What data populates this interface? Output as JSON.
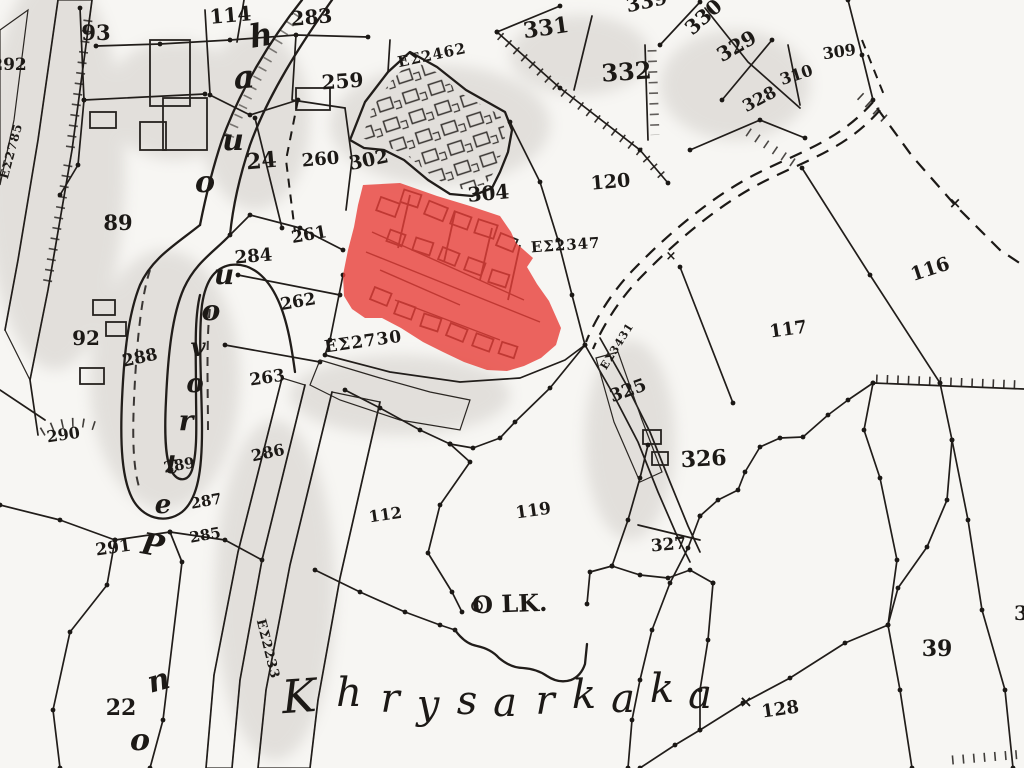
{
  "map": {
    "place_name": "Khrysarkaka",
    "landmark_text": "O LK.",
    "highlight_color": "#e73f38",
    "ink_color": "#211d1a",
    "paper_color": "#f6f5f2",
    "highlight_adjacent_refs": [
      "ΕΣ2347",
      "ΕΣ2730"
    ],
    "labels": [
      {
        "t": "93",
        "x": 96,
        "y": 40,
        "s": 21,
        "r": 0,
        "c": "num"
      },
      {
        "t": "114",
        "x": 231,
        "y": 22,
        "s": 20,
        "r": -5,
        "c": "num"
      },
      {
        "t": "283",
        "x": 312,
        "y": 24,
        "s": 20,
        "r": -5,
        "c": "num"
      },
      {
        "t": "292",
        "x": 9,
        "y": 70,
        "s": 17,
        "r": 0,
        "c": "num"
      },
      {
        "t": "259",
        "x": 343,
        "y": 88,
        "s": 20,
        "r": -4,
        "c": "num"
      },
      {
        "t": "ΕΣ2462",
        "x": 433,
        "y": 60,
        "s": 15,
        "r": -12,
        "c": "enum"
      },
      {
        "t": "331",
        "x": 547,
        "y": 35,
        "s": 22,
        "r": -8,
        "c": "num"
      },
      {
        "t": "332",
        "x": 627,
        "y": 80,
        "s": 24,
        "r": -4,
        "c": "num"
      },
      {
        "t": "339",
        "x": 648,
        "y": 8,
        "s": 20,
        "r": -12,
        "c": "num"
      },
      {
        "t": "330",
        "x": 708,
        "y": 22,
        "s": 20,
        "r": -42,
        "c": "num"
      },
      {
        "t": "329",
        "x": 740,
        "y": 52,
        "s": 20,
        "r": -30,
        "c": "num"
      },
      {
        "t": "310",
        "x": 798,
        "y": 80,
        "s": 16,
        "r": -18,
        "c": "num"
      },
      {
        "t": "309",
        "x": 840,
        "y": 57,
        "s": 16,
        "r": -8,
        "c": "num"
      },
      {
        "t": "328",
        "x": 762,
        "y": 104,
        "s": 17,
        "r": -28,
        "c": "num"
      },
      {
        "t": "24",
        "x": 262,
        "y": 168,
        "s": 22,
        "r": -5,
        "c": "num"
      },
      {
        "t": "260",
        "x": 321,
        "y": 165,
        "s": 18,
        "r": -5,
        "c": "num"
      },
      {
        "t": "302",
        "x": 370,
        "y": 166,
        "s": 19,
        "r": -12,
        "c": "num"
      },
      {
        "t": "304",
        "x": 489,
        "y": 200,
        "s": 20,
        "r": -5,
        "c": "num"
      },
      {
        "t": "261",
        "x": 310,
        "y": 240,
        "s": 17,
        "r": -10,
        "c": "num"
      },
      {
        "t": "284",
        "x": 254,
        "y": 262,
        "s": 18,
        "r": -5,
        "c": "num"
      },
      {
        "t": "89",
        "x": 118,
        "y": 230,
        "s": 21,
        "r": 0,
        "c": "num"
      },
      {
        "t": "262",
        "x": 299,
        "y": 307,
        "s": 17,
        "r": -10,
        "c": "num"
      },
      {
        "t": "92",
        "x": 86,
        "y": 345,
        "s": 20,
        "r": 0,
        "c": "num"
      },
      {
        "t": "288",
        "x": 141,
        "y": 363,
        "s": 17,
        "r": -12,
        "c": "num"
      },
      {
        "t": "263",
        "x": 268,
        "y": 383,
        "s": 17,
        "r": -8,
        "c": "num"
      },
      {
        "t": "290",
        "x": 64,
        "y": 440,
        "s": 16,
        "r": -8,
        "c": "num"
      },
      {
        "t": "286",
        "x": 269,
        "y": 458,
        "s": 16,
        "r": -12,
        "c": "num"
      },
      {
        "t": "289",
        "x": 180,
        "y": 470,
        "s": 15,
        "r": -10,
        "c": "num"
      },
      {
        "t": "287",
        "x": 207,
        "y": 506,
        "s": 15,
        "r": -10,
        "c": "num"
      },
      {
        "t": "285",
        "x": 206,
        "y": 540,
        "s": 15,
        "r": -10,
        "c": "num"
      },
      {
        "t": "291",
        "x": 114,
        "y": 553,
        "s": 17,
        "r": -8,
        "c": "num"
      },
      {
        "t": "22",
        "x": 121,
        "y": 715,
        "s": 22,
        "r": 0,
        "c": "num"
      },
      {
        "t": "112",
        "x": 386,
        "y": 520,
        "s": 16,
        "r": -8,
        "c": "num"
      },
      {
        "t": "119",
        "x": 534,
        "y": 516,
        "s": 17,
        "r": -8,
        "c": "num"
      },
      {
        "t": "120",
        "x": 611,
        "y": 188,
        "s": 19,
        "r": -5,
        "c": "num"
      },
      {
        "t": "ΕΣ2347",
        "x": 566,
        "y": 250,
        "s": 15,
        "r": -4,
        "c": "enum"
      },
      {
        "t": "ΕΣ2730",
        "x": 364,
        "y": 347,
        "s": 17,
        "r": -8,
        "c": "enum"
      },
      {
        "t": "116",
        "x": 932,
        "y": 275,
        "s": 19,
        "r": -18,
        "c": "num"
      },
      {
        "t": "117",
        "x": 789,
        "y": 335,
        "s": 18,
        "r": -8,
        "c": "num"
      },
      {
        "t": "325",
        "x": 630,
        "y": 396,
        "s": 18,
        "r": -20,
        "c": "num"
      },
      {
        "t": "ΕΣ3431",
        "x": 620,
        "y": 348,
        "s": 11,
        "r": -58,
        "c": "enum"
      },
      {
        "t": "326",
        "x": 704,
        "y": 466,
        "s": 22,
        "r": -3,
        "c": "num"
      },
      {
        "t": "327",
        "x": 669,
        "y": 550,
        "s": 17,
        "r": -5,
        "c": "num"
      },
      {
        "t": "O LK.",
        "x": 510,
        "y": 612,
        "s": 24,
        "r": -2,
        "c": "num"
      },
      {
        "t": "128",
        "x": 781,
        "y": 715,
        "s": 18,
        "r": -8,
        "c": "num"
      },
      {
        "t": "39",
        "x": 937,
        "y": 656,
        "s": 22,
        "r": 0,
        "c": "num"
      },
      {
        "t": "3",
        "x": 1021,
        "y": 620,
        "s": 20,
        "r": 0,
        "c": "num"
      },
      {
        "t": "ΕΣ2233",
        "x": 264,
        "y": 650,
        "s": 13,
        "r": 76,
        "c": "enum"
      },
      {
        "t": "ΕΣ2785",
        "x": 15,
        "y": 152,
        "s": 12,
        "r": -75,
        "c": "enum"
      },
      {
        "t": "×",
        "x": 746,
        "y": 707,
        "s": 16,
        "r": 0,
        "c": "mark"
      },
      {
        "t": "×",
        "x": 955,
        "y": 208,
        "s": 15,
        "r": 0,
        "c": "mark"
      },
      {
        "t": "×",
        "x": 671,
        "y": 260,
        "s": 13,
        "r": 0,
        "c": "mark"
      },
      {
        "t": "h",
        "x": 263,
        "y": 46,
        "s": 32,
        "r": -10,
        "c": "script"
      },
      {
        "t": "a",
        "x": 245,
        "y": 88,
        "s": 32,
        "r": -5,
        "c": "script"
      },
      {
        "t": "u",
        "x": 233,
        "y": 150,
        "s": 30,
        "r": 0,
        "c": "script"
      },
      {
        "t": "o",
        "x": 205,
        "y": 192,
        "s": 30,
        "r": 0,
        "c": "script"
      },
      {
        "t": "u",
        "x": 224,
        "y": 284,
        "s": 28,
        "r": 0,
        "c": "script"
      },
      {
        "t": "o",
        "x": 211,
        "y": 320,
        "s": 28,
        "r": 0,
        "c": "script"
      },
      {
        "t": "v",
        "x": 198,
        "y": 356,
        "s": 26,
        "r": 0,
        "c": "script"
      },
      {
        "t": "o",
        "x": 195,
        "y": 392,
        "s": 26,
        "r": 0,
        "c": "script"
      },
      {
        "t": "r",
        "x": 186,
        "y": 430,
        "s": 28,
        "r": 0,
        "c": "script"
      },
      {
        "t": "t",
        "x": 172,
        "y": 473,
        "s": 26,
        "r": 0,
        "c": "script"
      },
      {
        "t": "e",
        "x": 163,
        "y": 513,
        "s": 26,
        "r": 0,
        "c": "script"
      },
      {
        "t": "P",
        "x": 151,
        "y": 555,
        "s": 30,
        "r": 10,
        "c": "script"
      },
      {
        "t": "n",
        "x": 161,
        "y": 690,
        "s": 30,
        "r": -15,
        "c": "script"
      },
      {
        "t": "o",
        "x": 140,
        "y": 750,
        "s": 30,
        "r": 0,
        "c": "script"
      },
      {
        "t": "K",
        "x": 300,
        "y": 712,
        "s": 46,
        "r": -4,
        "c": "place"
      },
      {
        "t": "h",
        "x": 349,
        "y": 706,
        "s": 40,
        "r": 0,
        "c": "place"
      },
      {
        "t": "r",
        "x": 390,
        "y": 712,
        "s": 40,
        "r": 0,
        "c": "place"
      },
      {
        "t": "y",
        "x": 428,
        "y": 718,
        "s": 40,
        "r": 0,
        "c": "place"
      },
      {
        "t": "s",
        "x": 467,
        "y": 714,
        "s": 40,
        "r": 0,
        "c": "place"
      },
      {
        "t": "a",
        "x": 505,
        "y": 716,
        "s": 40,
        "r": 0,
        "c": "place"
      },
      {
        "t": "r",
        "x": 545,
        "y": 714,
        "s": 40,
        "r": 0,
        "c": "place"
      },
      {
        "t": "k",
        "x": 584,
        "y": 708,
        "s": 40,
        "r": 0,
        "c": "place"
      },
      {
        "t": "a",
        "x": 623,
        "y": 712,
        "s": 40,
        "r": 0,
        "c": "place"
      },
      {
        "t": "k",
        "x": 662,
        "y": 702,
        "s": 40,
        "r": 0,
        "c": "place"
      },
      {
        "t": "a",
        "x": 700,
        "y": 708,
        "s": 40,
        "r": 0,
        "c": "place"
      }
    ]
  }
}
